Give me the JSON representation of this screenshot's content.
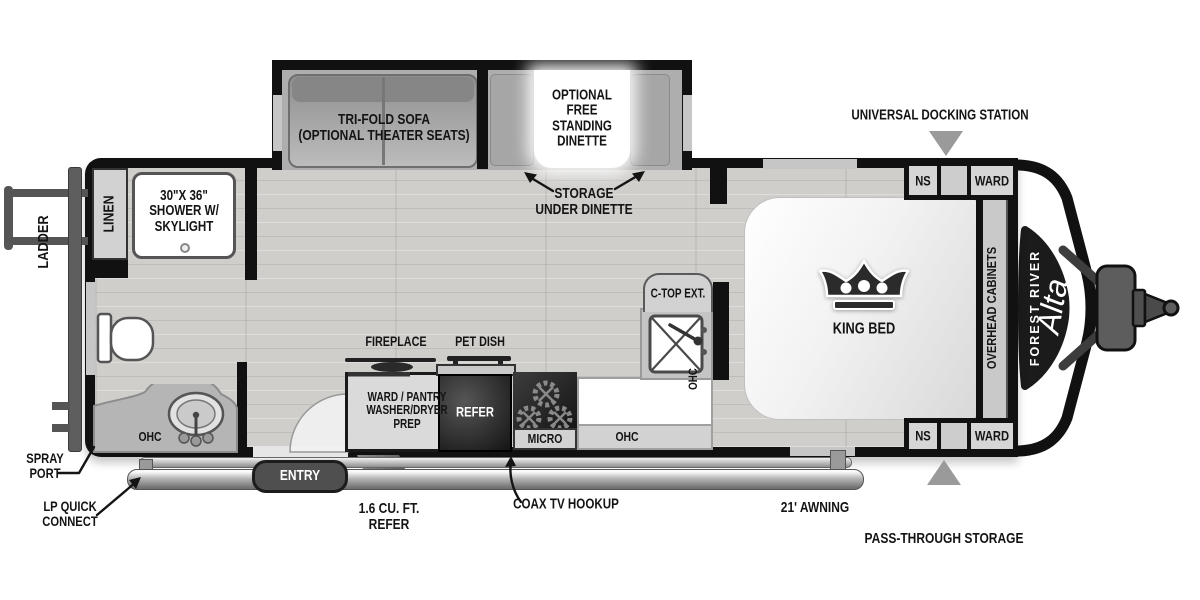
{
  "meta": {
    "product": "Forest River Alta travel trailer floorplan"
  },
  "colors": {
    "wall": "#111111",
    "floor": "#d0cecb",
    "slideout_floor": "#aeaeae",
    "marker": "#9a9a9a",
    "dark_appliance": "#1e1e1e",
    "cabinet": "#d2d2d2"
  },
  "exterior_labels": {
    "ladder": "LADDER",
    "spray_port": "SPRAY\nPORT",
    "lp_quick_connect": "LP QUICK\nCONNECT",
    "universal_docking_station": "UNIVERSAL DOCKING STATION",
    "pass_through_storage": "PASS-THROUGH STORAGE",
    "awning": "21' AWNING",
    "entry": "ENTRY",
    "exterior_refer": "1.6 CU. FT.\nREFER",
    "coax_tv_hookup": "COAX TV HOOKUP"
  },
  "branding": {
    "make": "FOREST RIVER",
    "model": "Alta"
  },
  "slideout": {
    "sofa_label": "TRI-FOLD SOFA\n(OPTIONAL THEATER SEATS)",
    "dinette_label": "OPTIONAL\nFREE\nSTANDING\nDINETTE",
    "storage_label": "STORAGE\nUNDER DINETTE"
  },
  "bathroom": {
    "linen": "LINEN",
    "shower": "30\"X 36\"\nSHOWER W/\nSKYLIGHT",
    "ohc": "OHC"
  },
  "kitchen": {
    "fireplace": "FIREPLACE",
    "pet_dish": "PET DISH",
    "ward_pantry": "WARD / PANTRY\nWASHER/DRYER\nPREP",
    "refer": "REFER",
    "micro": "MICRO",
    "ohc": "OHC",
    "ohc_sink": "OHC",
    "countertop_ext": "C-TOP EXT."
  },
  "bedroom": {
    "bed": "KING BED",
    "overhead_cabinets": "OVERHEAD CABINETS",
    "ns_top": "NS",
    "ward_top": "WARD",
    "ns_bottom": "NS",
    "ward_bottom": "WARD"
  }
}
